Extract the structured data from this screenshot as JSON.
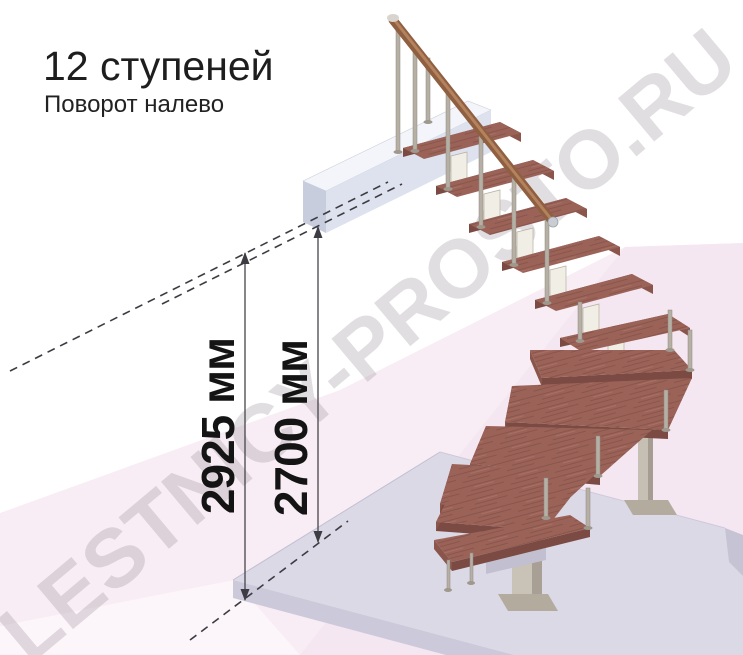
{
  "header": {
    "title": "12 ступеней",
    "subtitle": "Поворот налево"
  },
  "diagram": {
    "watermark": "LESTNICY-PROSTO.RU",
    "steps_count": "12",
    "turn_direction": "налево",
    "dimensions": {
      "floor_to_floor": "2925 мм",
      "floor_to_ceiling": "2700 мм"
    },
    "colors": {
      "tread_wood": "#9b6358",
      "tread_front": "#7b4b43",
      "handrail": "#8f5f42",
      "baluster": "#b5afa4",
      "floor_tint": "#f8edf4",
      "base_slab": "#dcd9e7",
      "landing_front": "#dde2ee",
      "dimension_text": "#141414"
    }
  }
}
